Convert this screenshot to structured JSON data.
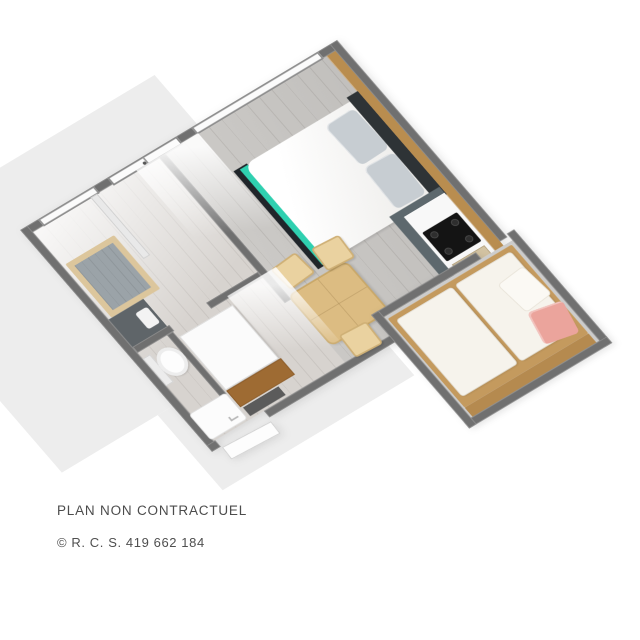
{
  "caption": {
    "line1": "PLAN NON CONTRACTUEL",
    "line2": "© R. C. S. 419 662 184"
  },
  "colors": {
    "wall": "#707070",
    "ground": "#ededed",
    "floor": "#cbc9c6",
    "wood_wall": "#b98d4f",
    "teal": "#2fd0b0",
    "bed_dark": "#20252a",
    "pillow": "#c7cdd2",
    "cabinet": "#5d686d",
    "cooktop": "#141414",
    "counter": "#f8f8f8",
    "table_wood": "#dcbc82",
    "chair_wood": "#ead2a0",
    "bunk_wood": "#c49a5e",
    "mattress": "#f6f3ec",
    "pink": "#eba49c",
    "text": "#4c4c4c"
  }
}
